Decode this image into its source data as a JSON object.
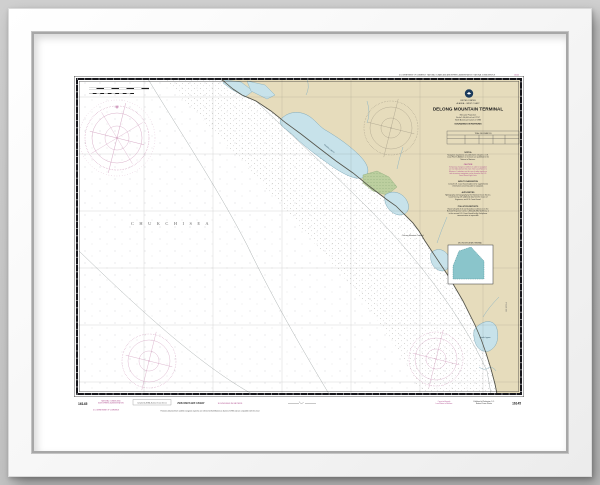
{
  "chart": {
    "top_margin": {
      "agency": "U.S. DEPARTMENT OF COMMERCE · NATIONAL OCEANIC AND ATMOSPHERIC ADMINISTRATION · NATIONAL OCEAN SERVICE",
      "number": "16145"
    },
    "title_block": {
      "country": "UNITED STATES",
      "region": "ALASKA – WEST COAST",
      "title": "DELONG MOUNTAIN TERMINAL",
      "projection": "Mercator Projection",
      "scale": "Scale 1:50,000 at Lat 67°52'",
      "datum": "North American Datum of 1983",
      "soundings": "SOUNDINGS IN FATHOMS",
      "table_title": "TIDAL INFORMATION",
      "notes": [
        {
          "heading": "NOTE A",
          "color": "#2e2e2e",
          "lines": [
            "Navigation regulations are published in Chapter 2, U.S.",
            "Coast Pilot 9. Additions or revisions are published in the",
            "Notices to Mariners."
          ]
        },
        {
          "heading": "CAUTION",
          "color": "#b05090",
          "lines": [
            "Temporary changes or defects in aids to navigation",
            "are not indicated on this chart. See Local Notice to",
            "Mariners. Limitations on the use of radio signals as",
            "aids to marine navigation can be found in the U.S.",
            "Coast Guard Light Lists."
          ]
        },
        {
          "heading": "AIDS TO NAVIGATION",
          "color": "#2e2e2e",
          "lines": [
            "Consult U.S. Coast Guard Light List for supplemental",
            "information concerning aids to navigation."
          ]
        },
        {
          "heading": "AUTHORITIES",
          "color": "#2e2e2e",
          "lines": [
            "Hydrography and topography by the National Ocean Service,",
            "Coast Survey, with additional data from the Corps of",
            "Engineers, and U.S. Coast Guard."
          ]
        },
        {
          "heading": "POLLUTION REPORTS",
          "color": "#2e2e2e",
          "lines": [
            "Report all spills of oil and hazardous substances to the",
            "National Response Center, 1-800-424-8802 (toll free), or",
            "to the nearest U.S. Coast Guard facility if telephone",
            "communication is impossible."
          ]
        }
      ]
    },
    "labels": {
      "sea": "C H U K C H I    S E A",
      "lagoon_north": "Kivalina Lagoon",
      "lagoon_south": "Ipiavik Lagoon",
      "terminal": "DeLong Mountain Terminal",
      "inset_title": "DELONG MOUNTAIN TERMINAL",
      "margin_note": "SEE NOTE A"
    },
    "bottom_margin": {
      "number_left": "16145",
      "number_right": "16145",
      "stamp_lines": [
        "NATIONAL OCEANIC AND",
        "ATMOSPHERIC ADMINISTRATION"
      ],
      "stamp_sub": "U.S. DEPARTMENT OF COMMERCE",
      "box_label": "Compiled by NOAA, National Ocean Service",
      "preliminary": "PRELIMINARY CHART",
      "soundings_note": "SOUNDINGS IN METERS",
      "right_magenta_lines": [
        "Corrected through",
        "Local Notice to Mariners"
      ],
      "right_black_lines": [
        "Published at Washington, D.C.",
        "National Ocean Service"
      ],
      "datum_line": "Positions obtained from satellite navigation systems are referred to North American Datum of 1983 and are compatible with this chart"
    }
  },
  "colors": {
    "land": "#e6dcbc",
    "shallow_water": "#c7e2ea",
    "chart_magenta": "#b05090",
    "inset_teal": "#8ac5cb",
    "marsh_green": "#bccf9f"
  }
}
